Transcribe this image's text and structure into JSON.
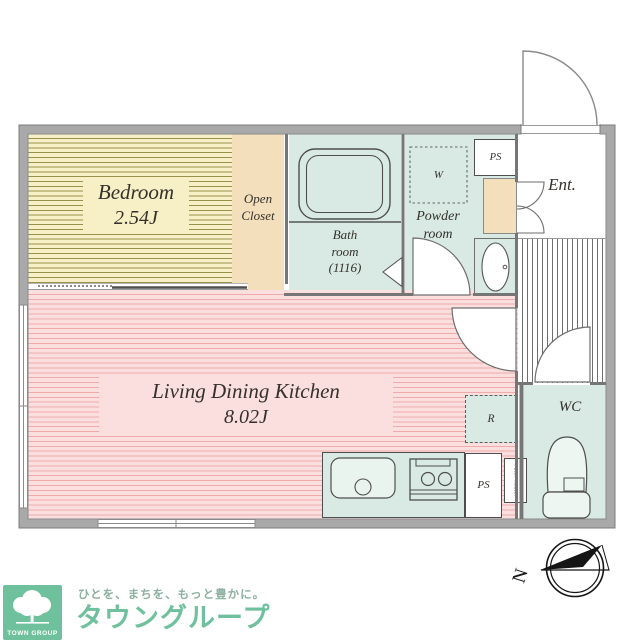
{
  "plan": {
    "rooms": {
      "bedroom": {
        "name": "Bedroom",
        "size": "2.54J"
      },
      "open_closet": {
        "line1": "Open",
        "line2": "Closet"
      },
      "bath": {
        "line1": "Bath",
        "line2": "room",
        "line3": "(1116)"
      },
      "powder": {
        "line1": "Powder",
        "line2": "room"
      },
      "washer_label": "W",
      "ps_top": "PS",
      "entrance": "Ent.",
      "ldk": {
        "name": "Living Dining Kitchen",
        "size": "8.02J"
      },
      "wc": "WC",
      "refrigerator_label": "R",
      "ps_bottom": "PS",
      "water_heater": "Water heater"
    },
    "compass": {
      "north_label": "N"
    }
  },
  "branding": {
    "logo_box_text": "TOWN GROUP",
    "tagline": "ひとを、まちを、もっと豊かに。",
    "brand_name": "タウングループ"
  },
  "colors": {
    "wall_gray": "#a9a9a9",
    "bedroom_yellow": "#f7f0c6",
    "bedroom_stripe": "#99904a",
    "closet_beige": "#f3dfbc",
    "room_teal": "#d9eae4",
    "ldk_pink": "#fadfde",
    "ldk_stripe": "#edabab",
    "brand_green": "#6fc09c",
    "tagline_green": "#8cafa0"
  }
}
